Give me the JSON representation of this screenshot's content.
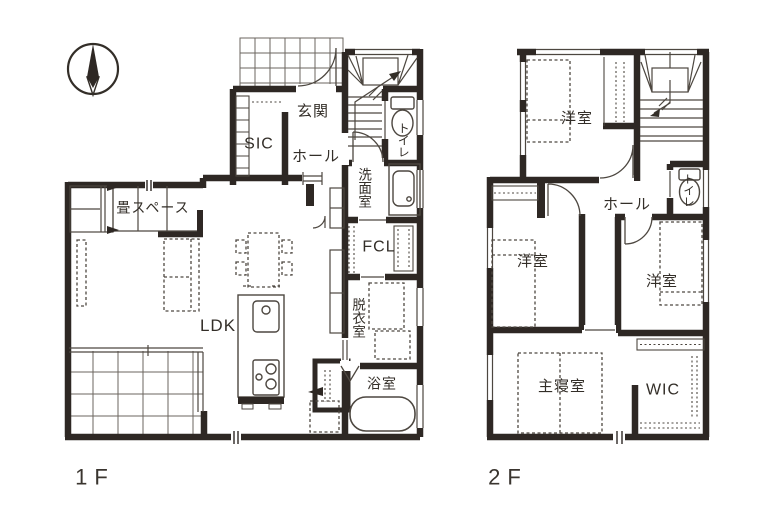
{
  "title": "2-story house floor plan",
  "colors": {
    "wall": "#2e2824",
    "thin_line": "#4d4740",
    "grid_line": "#6b665f",
    "text": "#332e28",
    "background": "#ffffff"
  },
  "symbols": [
    "north-compass-icon",
    "stairs-icon",
    "toilet-icon",
    "bathtub-icon",
    "kitchen-island-icon",
    "sink-icon",
    "stove-icon",
    "washbasin-icon",
    "bed-icon",
    "sofa-icon",
    "dining-table-icon",
    "washing-machine-icon",
    "porch-tile-grid",
    "deck-tile-grid",
    "door-swing-arc"
  ],
  "floor1": {
    "floor_label": "1F",
    "rooms": {
      "genkan": "玄関",
      "sic": "SIC",
      "hall": "ホール",
      "toilet": "トイレ",
      "washroom": "洗面室",
      "fcl": "FCL",
      "dressing": "脱衣室",
      "bath": "浴室",
      "ldk": "LDK",
      "tatami": "畳スペース"
    }
  },
  "floor2": {
    "floor_label": "2F",
    "rooms": {
      "bedroom1": "洋室",
      "bedroom2": "洋室",
      "bedroom3": "洋室",
      "hall": "ホール",
      "toilet": "トイレ",
      "master": "主寝室",
      "wic": "WIC"
    }
  }
}
